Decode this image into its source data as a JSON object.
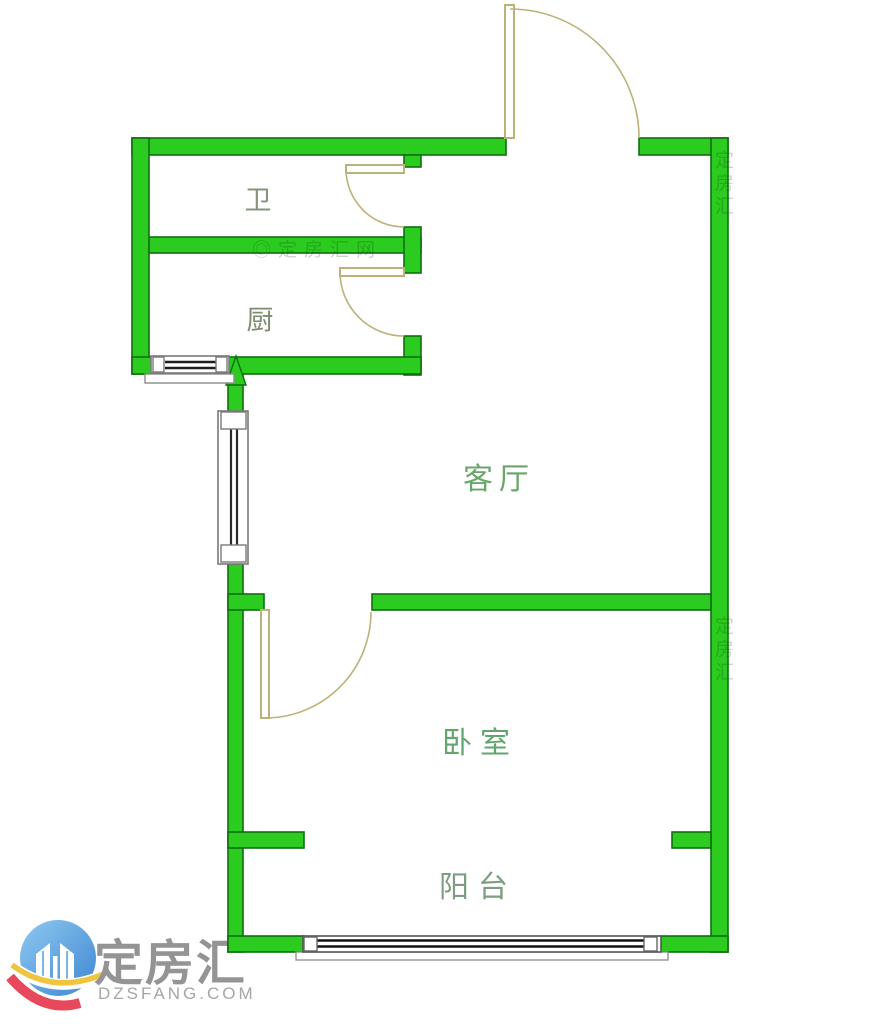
{
  "page": {
    "width": 882,
    "height": 1024,
    "background": "#ffffff"
  },
  "floor_plan": {
    "rooms": [
      {
        "key": "bathroom",
        "label": "卫"
      },
      {
        "key": "kitchen",
        "label": "厨"
      },
      {
        "key": "living_room",
        "label": "客厅"
      },
      {
        "key": "bedroom",
        "label": "卧室"
      },
      {
        "key": "balcony",
        "label": "阳台"
      }
    ],
    "colors": {
      "wall_fill": "#2bcb1f",
      "wall_outline": "#0e6f10",
      "door_arc": "#bcb279",
      "window_glass": "#1e1e1e",
      "window_frame": "#7a7a7a",
      "north_arrow": "#2bcb1f"
    },
    "icons": [
      "north-arrow-icon",
      "entrance-door",
      "bathroom-door",
      "kitchen-door",
      "bedroom-door",
      "kitchen-window",
      "living-room-window",
      "balcony-window"
    ],
    "watermark": {
      "text_wall": "◎定房汇网",
      "text_side": "定房汇"
    }
  },
  "logo": {
    "brand": "定房汇",
    "domain": "DZSFANG.COM",
    "colors": {
      "blue": "#4d9bdc",
      "blue_light": "#85c3ee",
      "red": "#e8485c",
      "yellow": "#efc43f",
      "text": "#949494"
    }
  }
}
